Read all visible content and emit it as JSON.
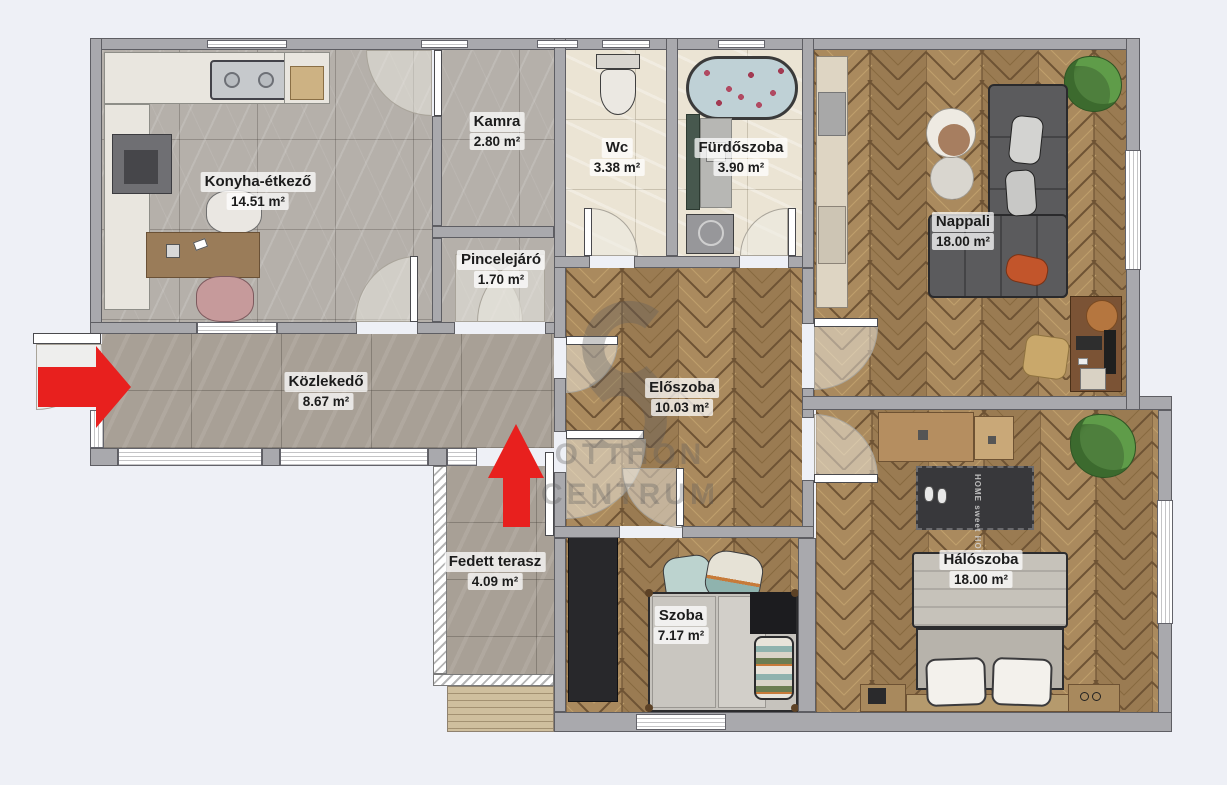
{
  "plan": {
    "rooms": [
      {
        "id": "konyha",
        "name": "Konyha-étkező",
        "area": "14.51 m²"
      },
      {
        "id": "kamra",
        "name": "Kamra",
        "area": "2.80 m²"
      },
      {
        "id": "wc",
        "name": "Wc",
        "area": "3.38 m²"
      },
      {
        "id": "furdoszoba",
        "name": "Fürdőszoba",
        "area": "3.90 m²"
      },
      {
        "id": "nappali",
        "name": "Nappali",
        "area": "18.00 m²"
      },
      {
        "id": "pincelejaro",
        "name": "Pincelejáró",
        "area": "1.70 m²"
      },
      {
        "id": "kozlekedo",
        "name": "Közlekedő",
        "area": "8.67 m²"
      },
      {
        "id": "eloszoba",
        "name": "Előszoba",
        "area": "10.03 m²"
      },
      {
        "id": "fedett_terasz",
        "name": "Fedett terasz",
        "area": "4.09 m²"
      },
      {
        "id": "szoba",
        "name": "Szoba",
        "area": "7.17 m²"
      },
      {
        "id": "haloszoba",
        "name": "Hálószoba",
        "area": "18.00 m²"
      }
    ],
    "watermark": {
      "line1": "OTTHON",
      "line2": "CENTRUM"
    },
    "bedroom_rug_text": "HOME sweet HOME",
    "colors": {
      "background": "#eef0f6",
      "wall": "#a9a9ad",
      "arrow": "#e8201e",
      "wood_light": "#aa8a5e",
      "wood_dark": "#9a7b52",
      "marble": "#b5b0aa",
      "beige_tile": "#ebe4d4",
      "gray_tile": "#a8a096",
      "sofa": "#5b5b5d"
    }
  }
}
